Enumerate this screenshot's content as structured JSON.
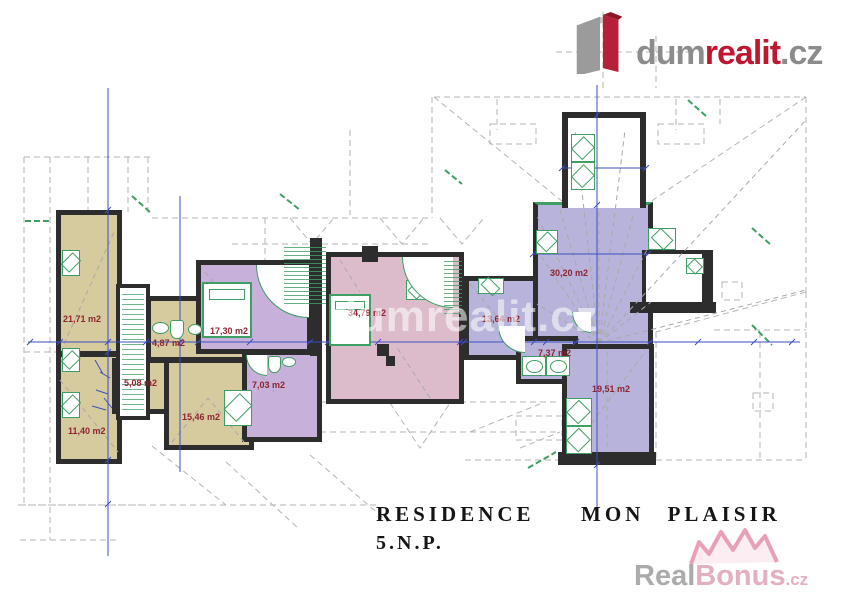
{
  "brand": {
    "logo_gray": "dum",
    "logo_red": "realit",
    "logo_tld": ".cz"
  },
  "title": {
    "line1": "RESIDENCE  MON PLAISIR",
    "line2": "5.N.P."
  },
  "rooms": [
    {
      "id": "room-21-71",
      "area": "21,71 m2"
    },
    {
      "id": "room-11-40",
      "area": "11,40 m2"
    },
    {
      "id": "room-4-87",
      "area": "4,87 m2"
    },
    {
      "id": "room-5-08",
      "area": "5,08 m2"
    },
    {
      "id": "room-15-46",
      "area": "15,46 m2"
    },
    {
      "id": "room-17-30",
      "area": "17,30 m2"
    },
    {
      "id": "room-7-03",
      "area": "7,03 m2"
    },
    {
      "id": "room-34-79",
      "area": "34,79 m2"
    },
    {
      "id": "room-13-64",
      "area": "13,64 m2"
    },
    {
      "id": "room-30-20",
      "area": "30,20 m2"
    },
    {
      "id": "room-7-37",
      "area": "7,37 m2"
    },
    {
      "id": "room-19-51",
      "area": "19,51 m2"
    }
  ],
  "watermarks": {
    "center": "dumrealit.cz",
    "corner_gray": "Real",
    "corner_pink": "Bonus",
    "corner_tld": ".cz"
  },
  "colors": {
    "unit_west_beige": "#d5cb9e",
    "unit_mid_purple": "#c7b0d9",
    "unit_pink": "#dcbccb",
    "unit_east_blue": "#b7b3da",
    "wall_black": "#2d2d2d",
    "fixture_green": "#3f9e63",
    "dimension_blue": "#3c4fc0",
    "area_label_red": "#8e2430",
    "roof_dash_gray": "#b5b5b5",
    "logo_red": "#c01731"
  }
}
